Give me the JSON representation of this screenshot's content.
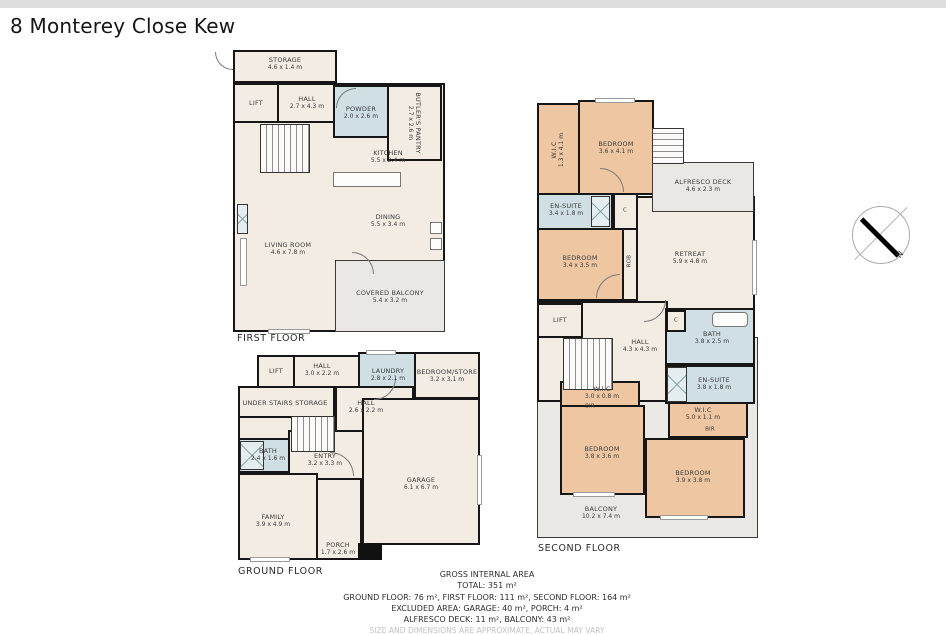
{
  "page": {
    "title": "8 Monterey Close Kew"
  },
  "compass": {
    "north_label": "N"
  },
  "floors": {
    "first": {
      "label": "FIRST FLOOR",
      "rooms": {
        "storage": {
          "name": "STORAGE",
          "dims": "4.6 x 1.4 m"
        },
        "lift": {
          "name": "LIFT"
        },
        "hall": {
          "name": "HALL",
          "dims": "2.7 x 4.3 m"
        },
        "powder": {
          "name": "POWDER",
          "dims": "2.0 x 2.6 m"
        },
        "butlers_pantry": {
          "name": "BUTLER'S PANTRY",
          "dims": "2.7 x 2.6 m"
        },
        "kitchen": {
          "name": "KITCHEN",
          "dims": "5.5 x 2.4 m"
        },
        "dining": {
          "name": "DINING",
          "dims": "5.5 x 3.4 m"
        },
        "living_room": {
          "name": "LIVING ROOM",
          "dims": "4.6 x 7.8 m"
        },
        "covered_balcony": {
          "name": "COVERED BALCONY",
          "dims": "5.4 x 3.2 m"
        }
      }
    },
    "ground": {
      "label": "GROUND FLOOR",
      "rooms": {
        "lift": {
          "name": "LIFT"
        },
        "hall_upper": {
          "name": "HALL",
          "dims": "3.0 x 2.2 m"
        },
        "laundry": {
          "name": "LAUNDRY",
          "dims": "2.8 x 2.1 m"
        },
        "bedroom_store": {
          "name": "BEDROOM/STORE",
          "dims": "3.2 x 3.1 m"
        },
        "under_stairs": {
          "name": "UNDER STAIRS STORAGE"
        },
        "hall_lower": {
          "name": "HALL",
          "dims": "2.6 x 2.2 m"
        },
        "bath": {
          "name": "BATH",
          "dims": "2.4 x 1.6 m"
        },
        "entry": {
          "name": "ENTRY",
          "dims": "3.2 x 3.3 m"
        },
        "garage": {
          "name": "GARAGE",
          "dims": "6.1 x 6.7 m"
        },
        "family": {
          "name": "FAMILY",
          "dims": "3.9 x 4.9 m"
        },
        "porch": {
          "name": "PORCH",
          "dims": "1.7 x 2.6 m"
        }
      }
    },
    "second": {
      "label": "SECOND FLOOR",
      "rooms": {
        "wic_top": {
          "name": "W.I.C",
          "dims": "1.3 x 4.1 m"
        },
        "bedroom_nw": {
          "name": "BEDROOM",
          "dims": "3.6 x 4.1 m"
        },
        "alfresco_deck": {
          "name": "ALFRESCO DECK",
          "dims": "4.6 x 2.3 m"
        },
        "ensuite_upper": {
          "name": "EN-SUITE",
          "dims": "3.4 x 1.8 m"
        },
        "bedroom_w": {
          "name": "BEDROOM",
          "dims": "3.4 x 3.5 m"
        },
        "robe": {
          "name": "ROB"
        },
        "retreat": {
          "name": "RETREAT",
          "dims": "5.9 x 4.8 m"
        },
        "lift": {
          "name": "LIFT"
        },
        "hall": {
          "name": "HALL",
          "dims": "4.3 x 4.3 m"
        },
        "bath": {
          "name": "BATH",
          "dims": "3.8 x 2.5 m"
        },
        "ensuite_lower": {
          "name": "EN-SUITE",
          "dims": "3.8 x 1.8 m"
        },
        "wic_mid": {
          "name": "W.I.C",
          "dims": "3.0 x 0.8 m"
        },
        "bir_mid": {
          "name": "BIR"
        },
        "wic_right": {
          "name": "W.I.C",
          "dims": "5.0 x 1.1 m"
        },
        "bir_right": {
          "name": "BIR"
        },
        "bedroom_sw": {
          "name": "BEDROOM",
          "dims": "3.8 x 3.6 m"
        },
        "bedroom_se": {
          "name": "BEDROOM",
          "dims": "3.9 x 3.8 m"
        },
        "balcony": {
          "name": "BALCONY",
          "dims": "10.2 x 7.4 m"
        },
        "cupboard_a": {
          "name": "C"
        },
        "cupboard_b": {
          "name": "C"
        }
      }
    }
  },
  "summary": {
    "line1": "GROSS INTERNAL AREA",
    "line2": "TOTAL: 351 m²",
    "line3": "GROUND FLOOR: 76 m², FIRST FLOOR: 111 m², SECOND FLOOR: 164 m²",
    "line4": "EXCLUDED AREA: GARAGE: 40 m², PORCH: 4 m²",
    "line5": "ALFRESCO DECK: 11 m², BALCONY: 43 m²",
    "disclaimer": "SIZE AND DIMENSIONS ARE APPROXIMATE, ACTUAL MAY VARY"
  }
}
